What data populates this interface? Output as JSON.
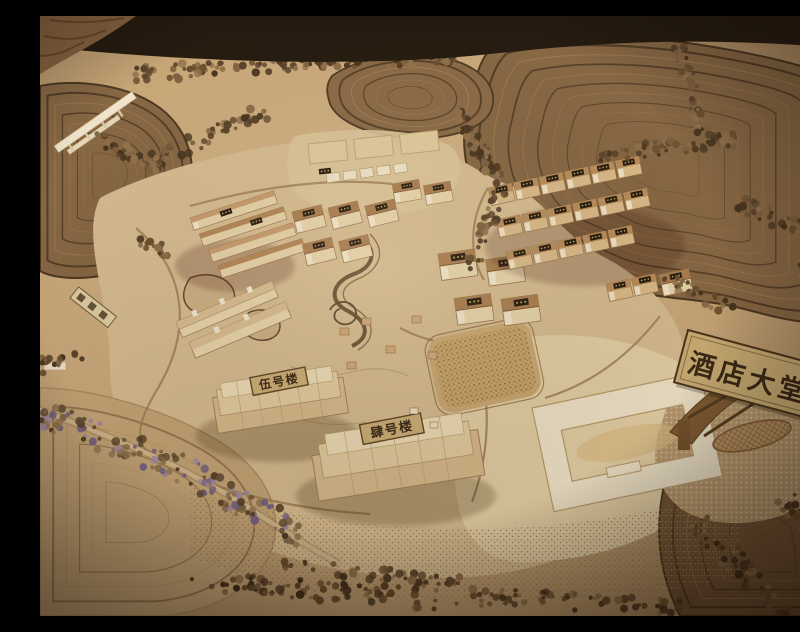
{
  "signs": {
    "hotel_lobby": {
      "label": "酒店大堂"
    },
    "building_5": {
      "label": "伍号楼"
    },
    "building_4": {
      "label": "肆号楼"
    }
  },
  "palette": {
    "table_dark": "#150e07",
    "terrain_tan": "#c9ab7f",
    "terrace_brown": "#7f6140",
    "contour_dark": "#3f2e1b",
    "site_pale": "#d5bd92",
    "plywood_light": "#e4d2a8",
    "building_wall": "#e8d7ae",
    "roof_brown": "#b08457",
    "sign_plaque": "#c9ae75",
    "sign_text": "#2e2010",
    "tree_dark": "#4a3621",
    "tree_purple": "#6f5e86"
  }
}
